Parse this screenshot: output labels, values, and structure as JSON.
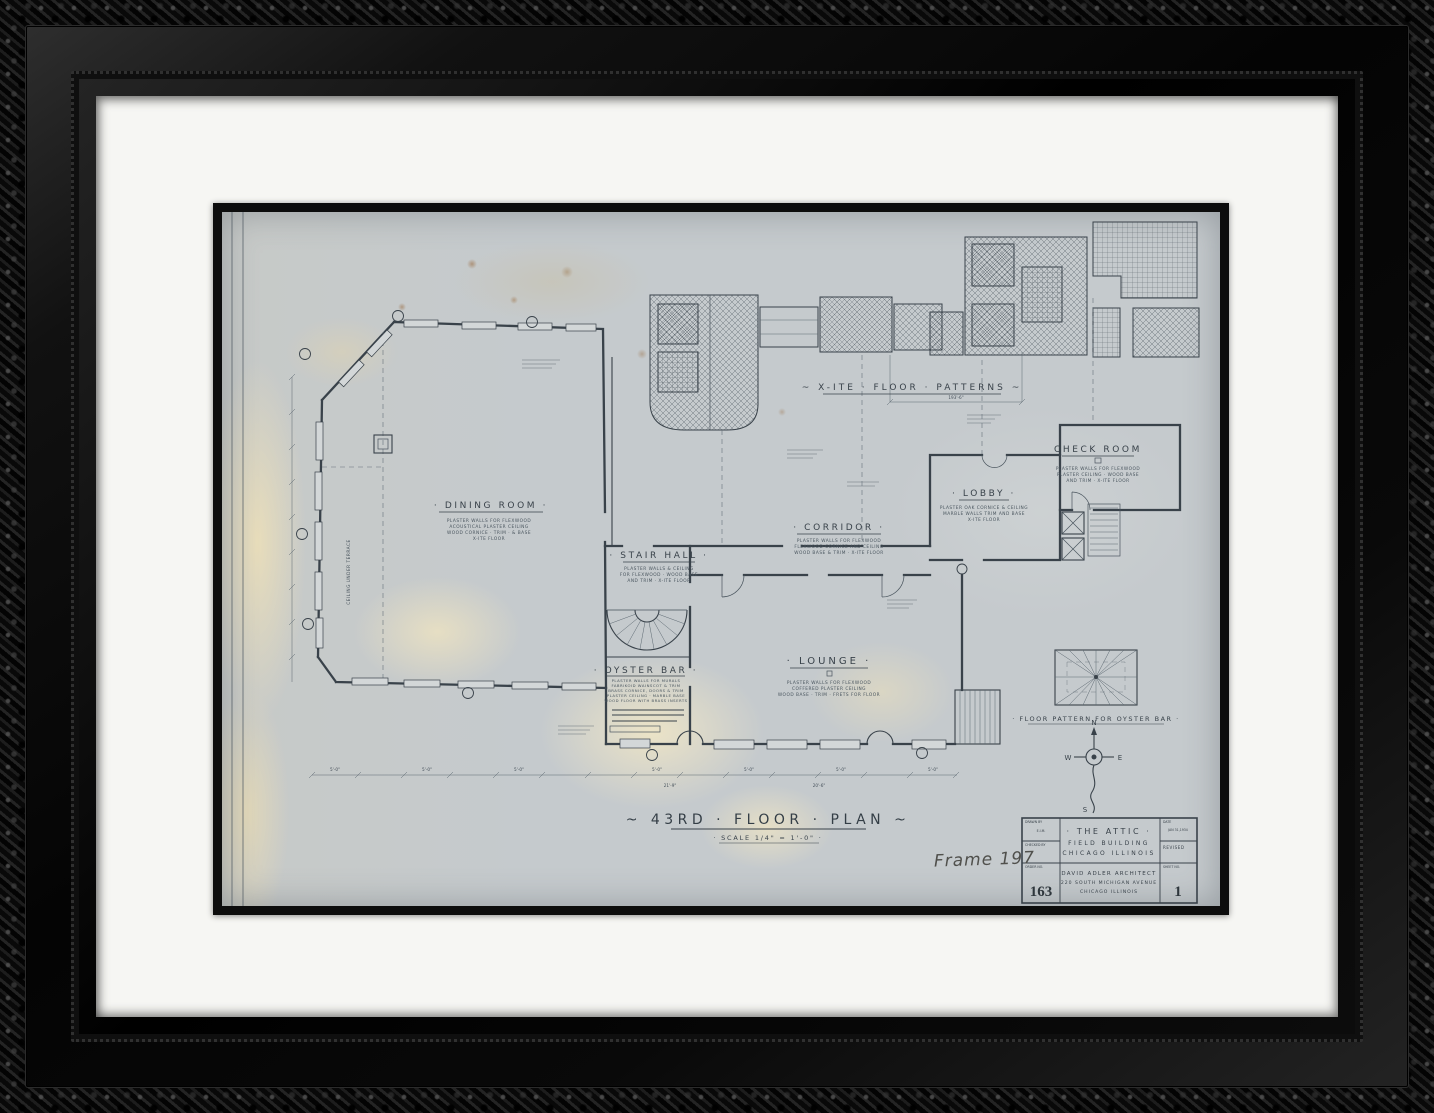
{
  "artwork": {
    "handwritten_label": "Frame 197",
    "plan": {
      "title": "~  43RD · FLOOR · PLAN  ~",
      "scale": "· SCALE   1/4\" = 1'-0\" ·",
      "patterns_title": "~  X-ITE · FLOOR · PATTERNS  ~",
      "patterns_dim": "193'-6\"",
      "oyster_pattern_caption": "· FLOOR  PATTERN  FOR  OYSTER  BAR ·",
      "bay_dim": "5'-0\"",
      "dim_left": "21'-9\"",
      "dim_right": "20'-6\"",
      "terrace_note": "CEILING UNDER TERRACE"
    },
    "compass": {
      "north": "N",
      "south": "S",
      "east": "E",
      "west": "W"
    },
    "rooms": {
      "dining": {
        "name": "· DINING  ROOM ·",
        "notes": [
          "PLASTER WALLS FOR FLEXWOOD",
          "ACOUSTICAL PLASTER CEILING",
          "WOOD CORNICE · TRIM · & BASE",
          "X-ITE FLOOR"
        ]
      },
      "stair_hall": {
        "name": "· STAIR  HALL ·",
        "notes": [
          "PLASTER WALLS & CEILING",
          "FOR FLEXWOOD · WOOD BASE",
          "AND TRIM · X-ITE FLOOR"
        ]
      },
      "corridor": {
        "name": "· CORRIDOR ·",
        "notes": [
          "PLASTER WALLS FOR FLEXWOOD",
          "FLEXWOOD CORNICE AND CEILING",
          "WOOD BASE & TRIM · X-ITE FLOOR"
        ]
      },
      "lobby": {
        "name": "· LOBBY ·",
        "notes": [
          "PLASTER OAK CORNICE & CEILING",
          "MARBLE WALLS TRIM AND BASE",
          "X-ITE FLOOR"
        ]
      },
      "check_room": {
        "name": "CHECK  ROOM",
        "notes": [
          "PLASTER WALLS FOR FLEXWOOD",
          "PLASTER CEILING · WOOD BASE",
          "AND TRIM · X-ITE FLOOR"
        ]
      },
      "oyster_bar": {
        "name": "· OYSTER  BAR ·",
        "notes": [
          "PLASTER WALLS FOR MURALS",
          "FABRIKOID WAINSCOT & TRIM",
          "BRASS CORNICE, DOORS & TRIM",
          "PLASTER CEILING · MARBLE BASE",
          "WOOD FLOOR WITH BRASS INSERTS"
        ]
      },
      "lounge": {
        "name": "· LOUNGE ·",
        "notes": [
          "PLASTER WALLS FOR FLEXWOOD",
          "COFFERED PLASTER CEILING",
          "WOOD BASE · TRIM · FRETS FOR FLOOR"
        ]
      }
    },
    "title_block": {
      "drawn_by_label": "DRAWN BY",
      "drawn_by": "E.I.M.",
      "checked_label": "CHECKED BY",
      "order_label": "ORDER NO.",
      "order_no": "163",
      "project_line1": "· THE  ATTIC ·",
      "project_line2": "FIELD  BUILDING",
      "project_line3": "CHICAGO  ILLINOIS",
      "architect_line1": "DAVID  ADLER  ARCHITECT",
      "architect_line2": "220 SOUTH MICHIGAN AVENUE",
      "architect_line3": "CHICAGO        ILLINOIS",
      "date_label": "DATE",
      "date_value": "JAN 31,1934",
      "revised_label": "REVISED",
      "sheet_label": "SHEET NO.",
      "sheet_no": "1"
    },
    "colors": {
      "sheet": "#c5cacd",
      "ink": "#39424a",
      "mat": "#f6f6f3",
      "frame": "#101010"
    }
  }
}
